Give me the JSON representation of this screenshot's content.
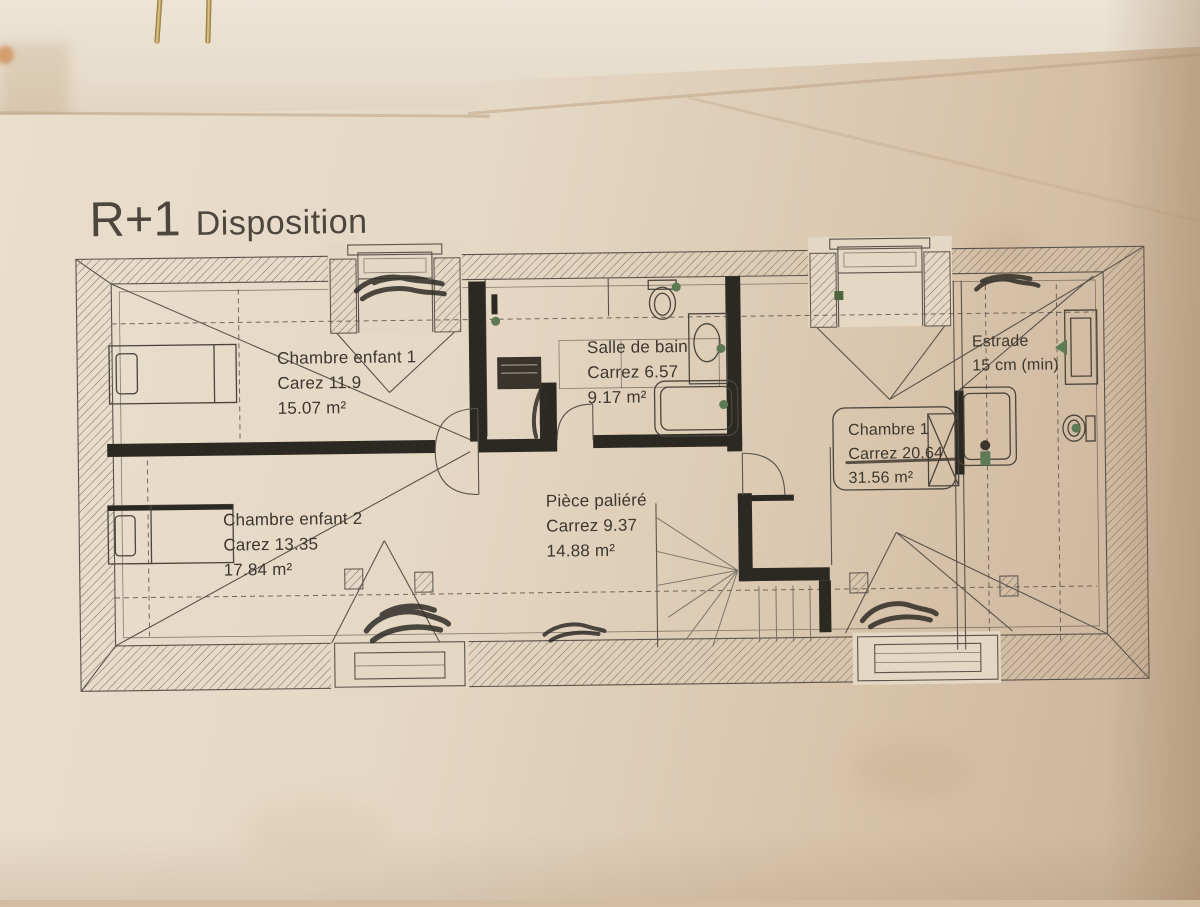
{
  "title": {
    "floor": "R+1",
    "label": "Disposition"
  },
  "rooms": {
    "chambre_enfant_1": {
      "name": "Chambre enfant 1",
      "carrez": "Carez 11.9",
      "area": "15.07 m²"
    },
    "chambre_enfant_2": {
      "name": "Chambre enfant 2",
      "carrez": "Carez 13.35",
      "area": "17.84 m²"
    },
    "salle_de_bain": {
      "name": "Salle de bain",
      "carrez": "Carrez 6.57",
      "area": "9.17 m²"
    },
    "piece_paliere": {
      "name": "Pièce paliéré",
      "carrez": "Carrez 9.37",
      "area": "14.88 m²"
    },
    "chambre_1": {
      "name": "Chambre 1",
      "carrez": "Carrez 20.64",
      "area": "31.56 m²"
    },
    "estrade": {
      "name": "Estrade",
      "note": "15 cm (min)"
    }
  },
  "colors": {
    "paper": "#e4d7c4",
    "paper_shadow": "#c9b298",
    "ink": "#5a534b",
    "wall": "#2c2822",
    "text": "#3c372f",
    "accent_green": "#5d7a55",
    "pin_brass": "#b2914a"
  }
}
